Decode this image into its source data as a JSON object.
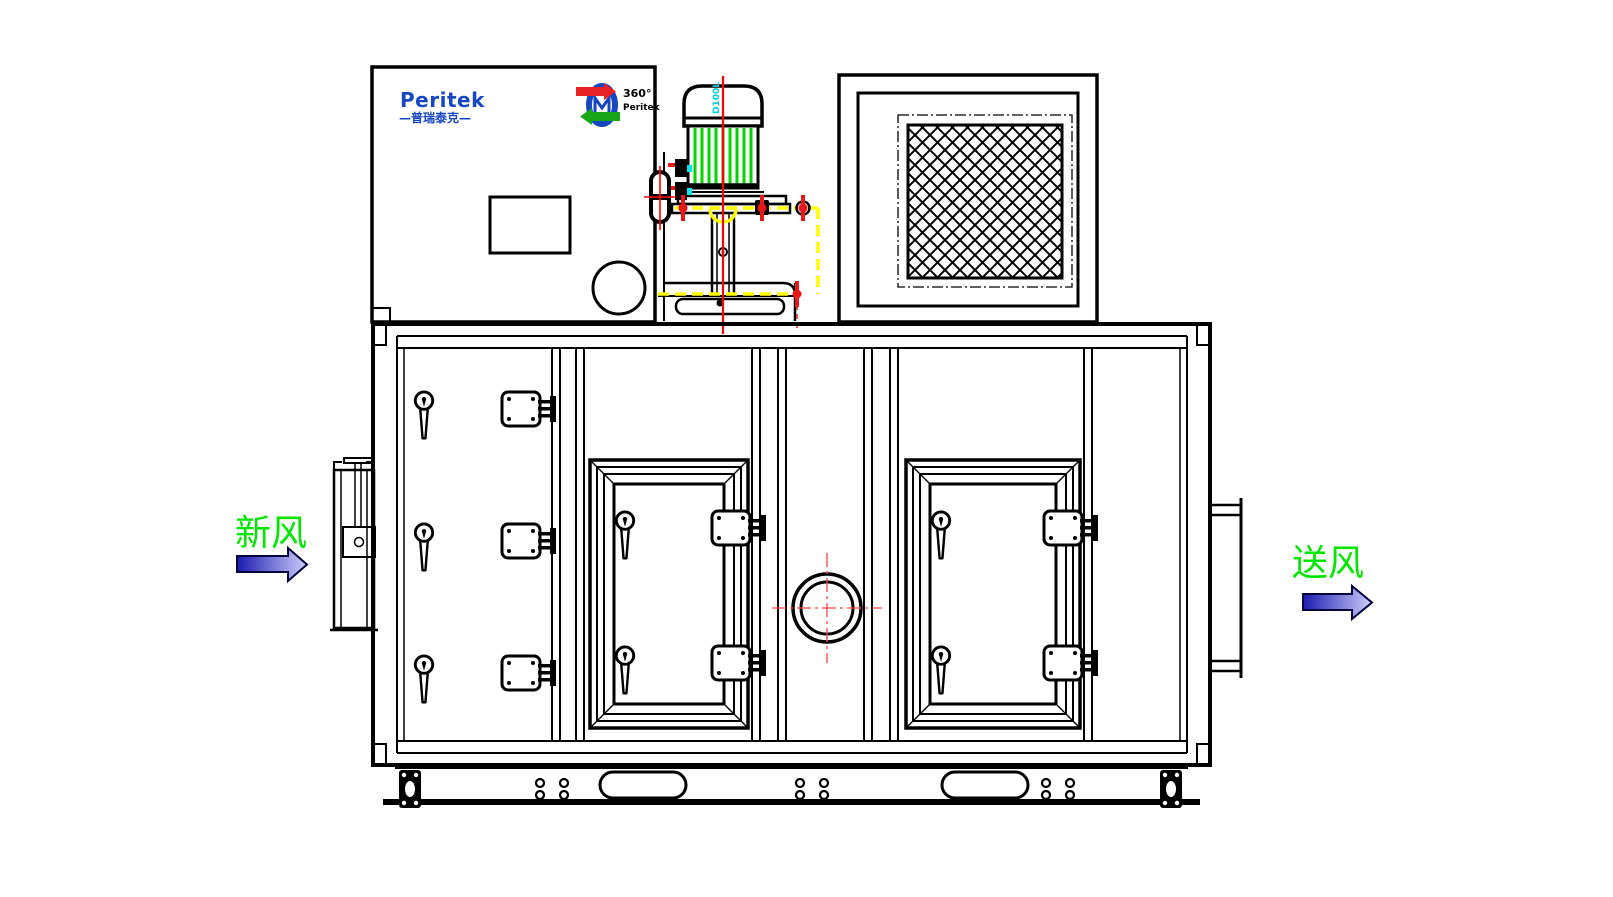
{
  "brand": {
    "logo_text": "Peritek",
    "logo_subtext": "—普瑞泰克—"
  },
  "wheel_logo": {
    "rotation_label": "360°",
    "brand_label": "Peritek"
  },
  "motor": {
    "model_label": "D100L"
  },
  "flow_labels": {
    "fresh_air": "新风",
    "supply_air": "送风"
  },
  "colors": {
    "logo_blue": "#1747c0",
    "fin_green": "#00d400",
    "label_green": "#00e400",
    "centerline_red": "#ff0000",
    "hatch_yellow": "#ffff00",
    "model_cyan": "#00cfe0",
    "arrow_dark": "#1b1bb0",
    "arrow_light": "#cdcdfa",
    "line_black": "#000000"
  }
}
